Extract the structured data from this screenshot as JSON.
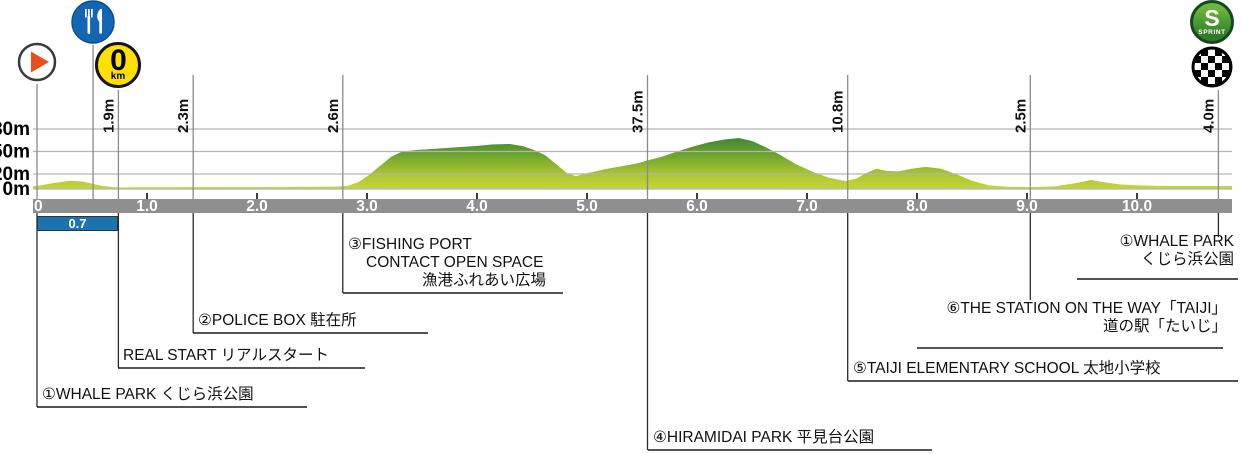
{
  "title": "Race course elevation profile with landmarks",
  "colors": {
    "profile_top": "#1a6638",
    "profile_mid": "#5d9b30",
    "profile_low": "#a9c42f",
    "profile_bottom": "#c9d83c",
    "bar": "#8f8f8f",
    "bar_text": "#ffffff",
    "grid": "#b3b3b3",
    "marker_line": "#8a8a8a",
    "connector": "#2b2b2b",
    "underline": "#1a1a1a",
    "section_box": "#1c73b0",
    "icon_start_triangle": "#e94e1b",
    "icon_feed": "#1266b4",
    "icon_zero_km": "#ffe100",
    "icon_sprint_dark": "#17471c",
    "icon_sprint_light": "#58a32d",
    "icon_finish": "#000000"
  },
  "y_axis": {
    "labels": [
      {
        "text": "80m",
        "elev": 80
      },
      {
        "text": "50m",
        "elev": 50
      },
      {
        "text": "20m",
        "elev": 20
      },
      {
        "text": "0m",
        "elev": 0
      }
    ]
  },
  "x_axis": {
    "ticks": [
      "0",
      "1.0",
      "2.0",
      "3.0",
      "4.0",
      "5.0",
      "6.0",
      "7.0",
      "8.0",
      "9.0",
      "10.0"
    ]
  },
  "icons": {
    "start": "play-arrow",
    "feed_zone": "fork-and-knife",
    "zero_km": {
      "big": "0",
      "small": "km"
    },
    "sprint": {
      "letter": "S",
      "word": "SPRINT"
    },
    "finish": "checkered-flag"
  },
  "section_box": {
    "value": "0.7"
  },
  "markers": [
    {
      "id": "start",
      "km": 0,
      "elev_label": ""
    },
    {
      "id": "feed_zone",
      "km": 0.51,
      "elev_label": ""
    },
    {
      "id": "real_start",
      "km": 0.74,
      "elev_label": "1.9m"
    },
    {
      "id": "police_box",
      "km": 1.42,
      "elev_label": "2.3m"
    },
    {
      "id": "fishing_port",
      "km": 2.78,
      "elev_label": "2.6m"
    },
    {
      "id": "hiramidai_park",
      "km": 5.55,
      "elev_label": "37.5m"
    },
    {
      "id": "elementary_school",
      "km": 7.37,
      "elev_label": "10.8m"
    },
    {
      "id": "station",
      "km": 9.03,
      "elev_label": "2.5m"
    },
    {
      "id": "finish",
      "km": 10.74,
      "elev_label": "4.0m"
    }
  ],
  "landmarks": {
    "whale_start": {
      "lines": [
        "①WHALE PARK くじら浜公園"
      ]
    },
    "real_start": {
      "lines": [
        "REAL START リアルスタート"
      ]
    },
    "police_box": {
      "lines": [
        "②POLICE BOX 駐在所"
      ]
    },
    "fishing_port": {
      "lines": [
        "③FISHING PORT",
        "CONTACT OPEN SPACE",
        "漁港ふれあい広場"
      ]
    },
    "hiramidai_park": {
      "lines": [
        "④HIRAMIDAI PARK 平見台公園"
      ]
    },
    "elementary_school": {
      "lines": [
        "⑤TAIJI ELEMENTARY SCHOOL 太地小学校"
      ]
    },
    "station": {
      "lines": [
        "⑥THE STATION ON THE WAY「TAIJI」",
        "道の駅「たいじ」"
      ]
    },
    "whale_finish": {
      "lines": [
        "①WHALE PARK",
        "くじら浜公園"
      ]
    }
  },
  "chart_data": {
    "type": "area",
    "title": "Course elevation profile",
    "x_unit": "km",
    "y_unit": "m",
    "xlim": [
      0,
      10.87
    ],
    "ylim": [
      0,
      92
    ],
    "y_gridlines": [
      80,
      50,
      20,
      0
    ],
    "x_tick_interval_km": 1,
    "profile": [
      [
        0,
        4
      ],
      [
        0.15,
        8
      ],
      [
        0.3,
        11
      ],
      [
        0.42,
        10
      ],
      [
        0.5,
        7
      ],
      [
        0.6,
        4
      ],
      [
        0.74,
        2
      ],
      [
        0.9,
        2.2
      ],
      [
        1.2,
        2.4
      ],
      [
        1.6,
        2.5
      ],
      [
        2.0,
        2.6
      ],
      [
        2.4,
        2.8
      ],
      [
        2.7,
        3.2
      ],
      [
        2.82,
        4
      ],
      [
        2.92,
        9
      ],
      [
        3.02,
        19
      ],
      [
        3.12,
        31
      ],
      [
        3.22,
        43
      ],
      [
        3.32,
        50
      ],
      [
        3.45,
        52
      ],
      [
        3.65,
        54
      ],
      [
        3.85,
        56
      ],
      [
        4.0,
        57.5
      ],
      [
        4.15,
        59.5
      ],
      [
        4.3,
        60
      ],
      [
        4.42,
        57
      ],
      [
        4.52,
        52
      ],
      [
        4.62,
        45
      ],
      [
        4.72,
        33
      ],
      [
        4.82,
        21
      ],
      [
        4.9,
        17
      ],
      [
        5.0,
        21
      ],
      [
        5.15,
        26
      ],
      [
        5.3,
        30
      ],
      [
        5.45,
        34
      ],
      [
        5.55,
        38
      ],
      [
        5.68,
        43
      ],
      [
        5.82,
        50
      ],
      [
        5.95,
        56
      ],
      [
        6.1,
        62
      ],
      [
        6.25,
        66
      ],
      [
        6.38,
        68
      ],
      [
        6.5,
        64
      ],
      [
        6.62,
        56
      ],
      [
        6.75,
        46
      ],
      [
        6.9,
        33
      ],
      [
        7.05,
        23
      ],
      [
        7.2,
        15
      ],
      [
        7.35,
        10.5
      ],
      [
        7.45,
        14
      ],
      [
        7.55,
        22
      ],
      [
        7.63,
        27
      ],
      [
        7.73,
        24
      ],
      [
        7.83,
        23.5
      ],
      [
        7.95,
        27
      ],
      [
        8.08,
        29.5
      ],
      [
        8.22,
        27
      ],
      [
        8.35,
        20
      ],
      [
        8.5,
        11
      ],
      [
        8.65,
        5
      ],
      [
        8.82,
        3
      ],
      [
        9.03,
        2.5
      ],
      [
        9.25,
        3.5
      ],
      [
        9.45,
        8
      ],
      [
        9.58,
        12
      ],
      [
        9.7,
        9
      ],
      [
        9.85,
        6
      ],
      [
        10.0,
        5
      ],
      [
        10.25,
        4
      ],
      [
        10.6,
        4
      ],
      [
        10.87,
        4
      ]
    ],
    "landmark_points": [
      {
        "name": "WHALE PARK (start)",
        "km": 0
      },
      {
        "name": "feed zone",
        "km": 0.51
      },
      {
        "name": "REAL START",
        "km": 0.74,
        "elevation_m": 1.9
      },
      {
        "name": "POLICE BOX",
        "km": 1.42,
        "elevation_m": 2.3
      },
      {
        "name": "FISHING PORT CONTACT OPEN SPACE",
        "km": 2.78,
        "elevation_m": 2.6
      },
      {
        "name": "HIRAMIDAI PARK",
        "km": 5.55,
        "elevation_m": 37.5
      },
      {
        "name": "TAIJI ELEMENTARY SCHOOL",
        "km": 7.37,
        "elevation_m": 10.8
      },
      {
        "name": "THE STATION ON THE WAY TAIJI",
        "km": 9.03,
        "elevation_m": 2.5
      },
      {
        "name": "WHALE PARK (finish)",
        "km": 10.74,
        "elevation_m": 4.0
      }
    ],
    "section_from_start_to_real_start_km": 0.7
  }
}
